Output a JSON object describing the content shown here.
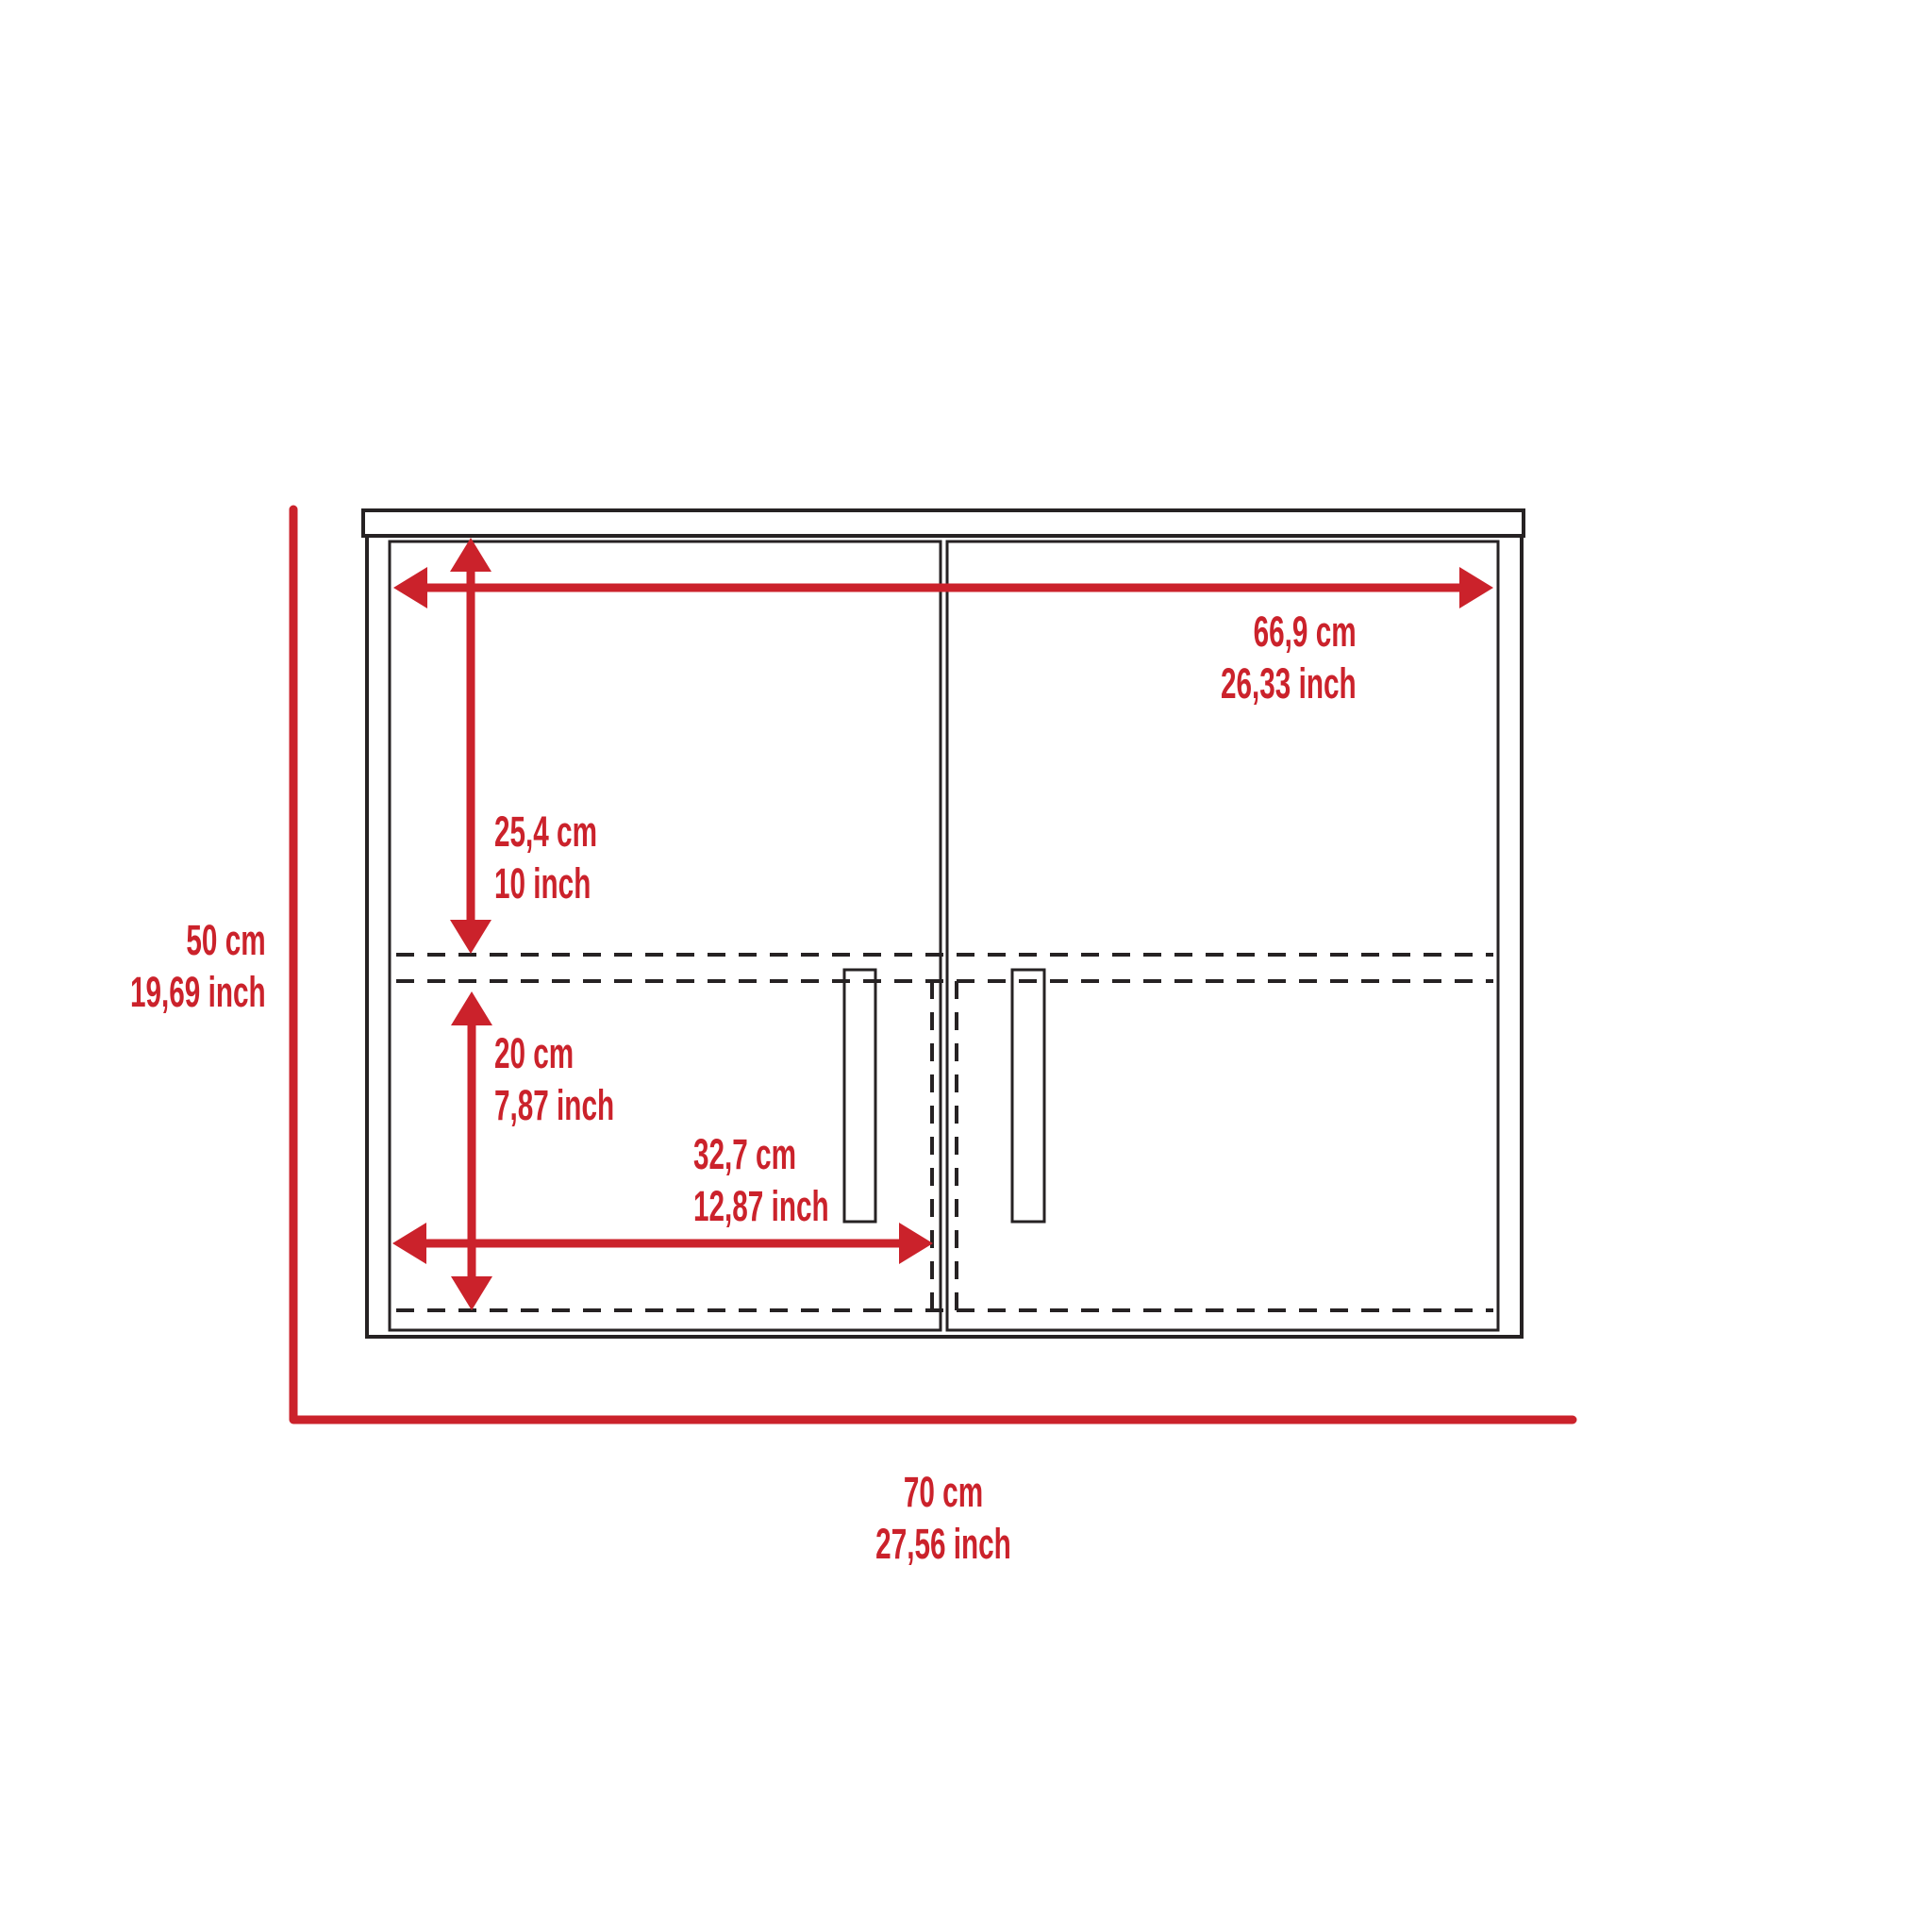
{
  "diagram": {
    "type": "furniture-dimension-drawing",
    "object": "two-door wall cabinet front view",
    "colors": {
      "dimension_red": "#cb222b",
      "line_black": "#262223",
      "background": "#ffffff"
    },
    "dimensions": {
      "interior_width": {
        "cm": "66,9 cm",
        "inch": "26,33 inch"
      },
      "upper_section_height": {
        "cm": "25,4 cm",
        "inch": "10 inch"
      },
      "lower_section_height": {
        "cm": "20 cm",
        "inch": "7,87 inch"
      },
      "door_width": {
        "cm": "32,7 cm",
        "inch": "12,87 inch"
      },
      "overall_height": {
        "cm": "50 cm",
        "inch": "19,69 inch"
      },
      "overall_width": {
        "cm": "70 cm",
        "inch": "27,56 inch"
      }
    }
  }
}
